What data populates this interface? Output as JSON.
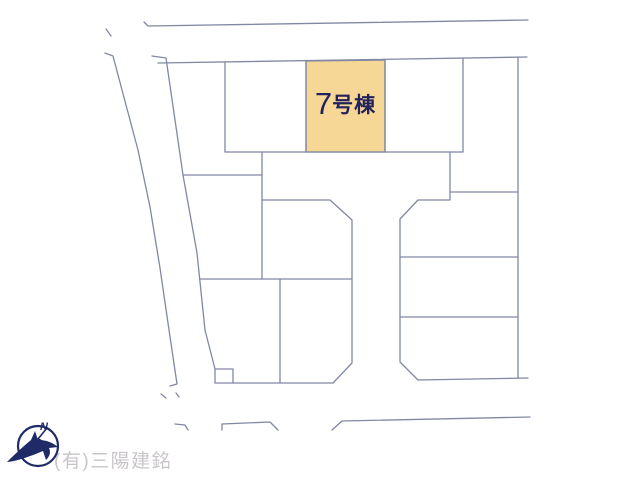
{
  "plan": {
    "unit_label": {
      "number": "7",
      "suffix": "号棟",
      "full": "7号棟"
    },
    "compass": {
      "north": "N"
    },
    "watermark": "(有)三陽建銘"
  },
  "colors": {
    "highlight_fill": "#F6D795",
    "line": "#8188A3",
    "label_text": "#23235C",
    "compass_navy": "#1F2B66",
    "watermark_gray": "#C8C4C9"
  }
}
